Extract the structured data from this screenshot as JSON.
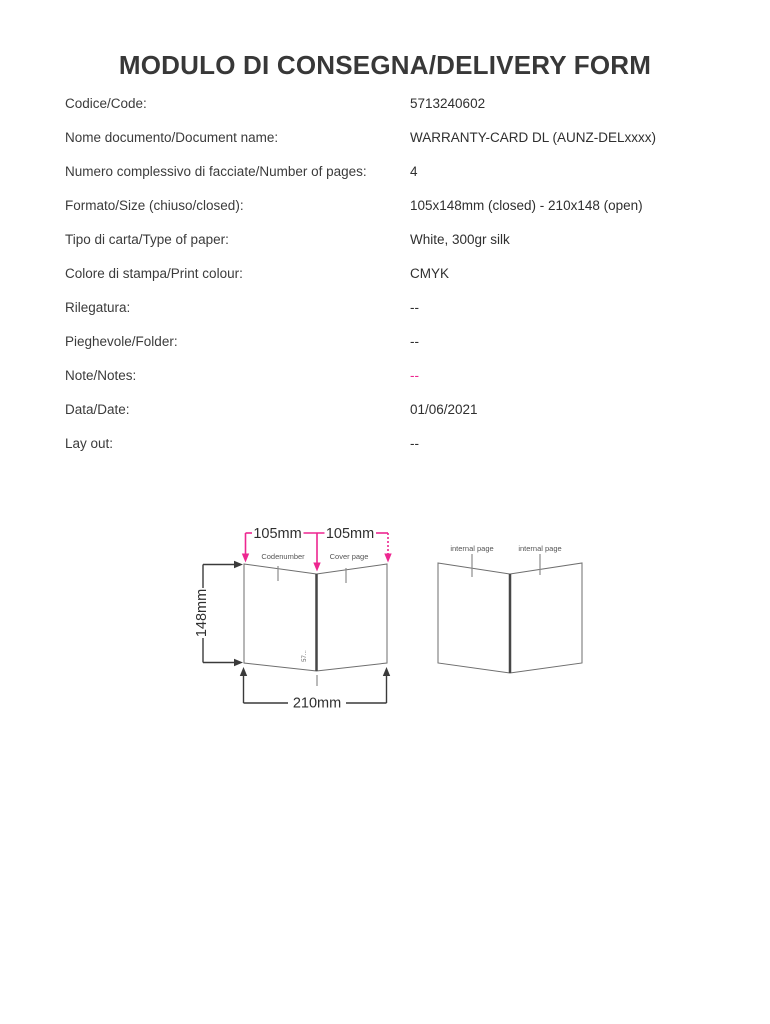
{
  "page": {
    "title": "MODULO DI CONSEGNA/DELIVERY FORM"
  },
  "form": {
    "rows": [
      {
        "label": "Codice/Code:",
        "value": "5713240602"
      },
      {
        "label": "Nome documento/Document name:",
        "value": "WARRANTY-CARD DL (AUNZ-DELxxxx)"
      },
      {
        "label": "Numero complessivo di facciate/Number of pages:",
        "value": "4"
      },
      {
        "label": "Formato/Size (chiuso/closed):",
        "value": "105x148mm (closed) - 210x148 (open)"
      },
      {
        "label": "Tipo di carta/Type of paper:",
        "value": "White, 300gr silk"
      },
      {
        "label": "Colore di stampa/Print colour:",
        "value": "CMYK"
      },
      {
        "label": "Rilegatura:",
        "value": "--"
      },
      {
        "label": "Pieghevole/Folder:",
        "value": "--"
      },
      {
        "label": "Note/Notes:",
        "value": "--",
        "accent": true
      },
      {
        "label": "Data/Date:",
        "value": "01/06/2021"
      },
      {
        "label": "Lay out:",
        "value": "--"
      }
    ]
  },
  "diagram": {
    "card_outside": {
      "top_dim_left": "105mm",
      "top_dim_right": "105mm",
      "height_dim": "148mm",
      "width_dim": "210mm",
      "left_panel_label": "Codenumber",
      "right_panel_label": "Cover page",
      "spine_note": "57..."
    },
    "card_inside": {
      "left_panel_label": "internal page",
      "right_panel_label": "internal page"
    },
    "colors": {
      "accent_pink": "#ED2690",
      "outline_gray": "#6e6e6e",
      "dimension_black": "#3a3a3a"
    }
  }
}
